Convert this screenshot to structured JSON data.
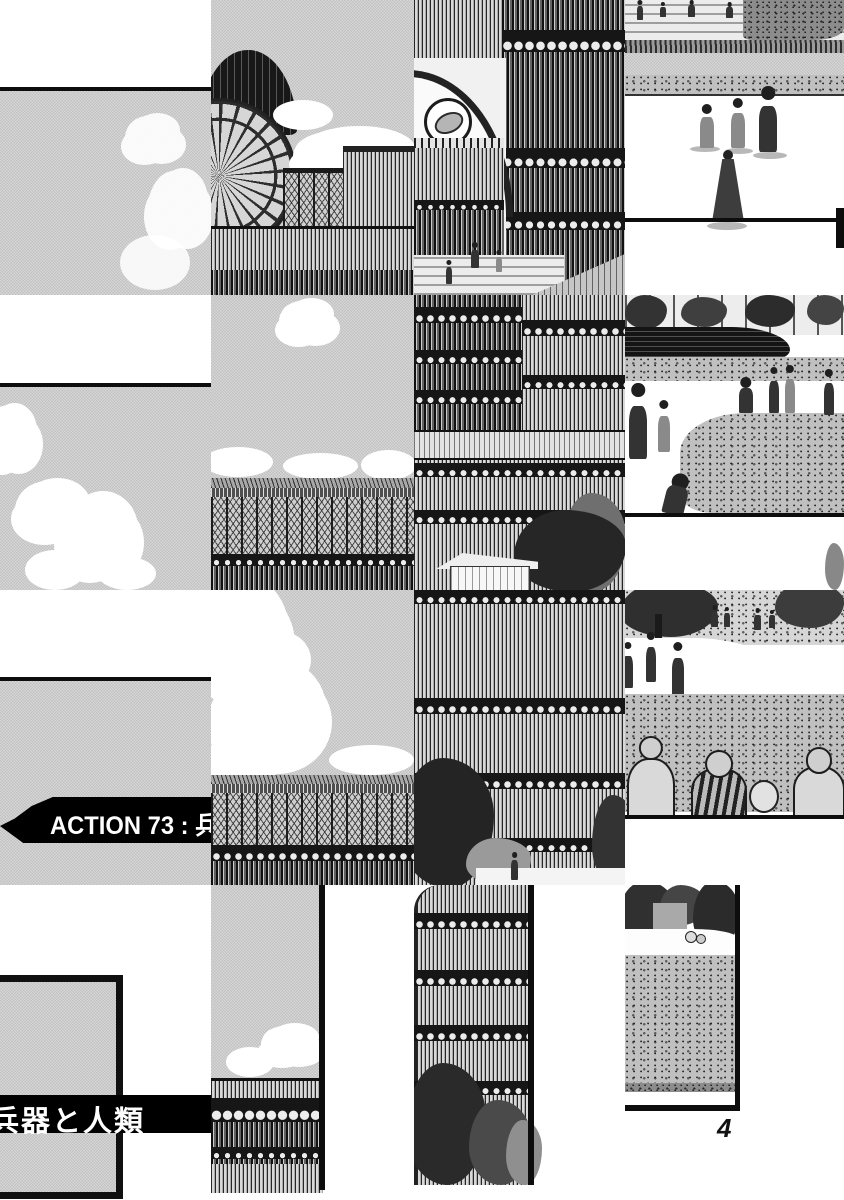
{
  "page": {
    "kind": "manga page (scrambled 4x4 tiles)",
    "chapter_banner": "ACTION 73 : 兵",
    "subtitle_banner": "兵器と人類",
    "page_number": "4"
  },
  "colors": {
    "paper": "#ffffff",
    "ink": "#0d0d0d",
    "halftone_sky": "#cbcbcb",
    "banner_bg": "#000000",
    "banner_text": "#ffffff"
  },
  "tiles": [
    {
      "id": "r1c1",
      "alt": "white margin, black rule, halftone sky with small clouds"
    },
    {
      "id": "r1c2",
      "alt": "dark dome and radial glass fan of crystal palace, clouds, half-timber halls, colonnade"
    },
    {
      "id": "r1c3",
      "alt": "glass facade with arched entrance, clock ring, staircase with visitors, ramp"
    },
    {
      "id": "r1c4",
      "alt": "terraced steps with strollers, hedges, plaza with playing children, man in coat, woman in long dress"
    },
    {
      "id": "r2c1",
      "alt": "white margin, black rule, halftone sky with cumulus puffs"
    },
    {
      "id": "r2c2",
      "alt": "halftone sky over long gallery roof with lattice balustrade"
    },
    {
      "id": "r2c3",
      "alt": "dense multi-storey glass facade, small gabled kiosk and trees below"
    },
    {
      "id": "r2c4",
      "alt": "park with dark pond, curving white path, strollers, running child, crouching boy"
    },
    {
      "id": "r3c1",
      "alt": "white margin, black rule, halftone sky, black chapter ribbon ACTION 73"
    },
    {
      "id": "r3c2",
      "alt": "halftone sky with large cumulus, gallery roof and balustrade below"
    },
    {
      "id": "r3c3",
      "alt": "tall glass facade with spandrel bands, dark trees at base"
    },
    {
      "id": "r3c4",
      "alt": "park lawn with trees, walkers on white path, backs of seated onlookers"
    },
    {
      "id": "r4c1",
      "alt": "panel corner with halftone fill and black subtitle band"
    },
    {
      "id": "r4c2",
      "alt": "narrow sky column with clouds over ornate facade, panel border"
    },
    {
      "id": "r4c3",
      "alt": "curved glass transept wall with shrubs, panel border"
    },
    {
      "id": "r4c4",
      "alt": "park panel with trees, pond glimpse, lawn, panel frame and page number"
    }
  ]
}
